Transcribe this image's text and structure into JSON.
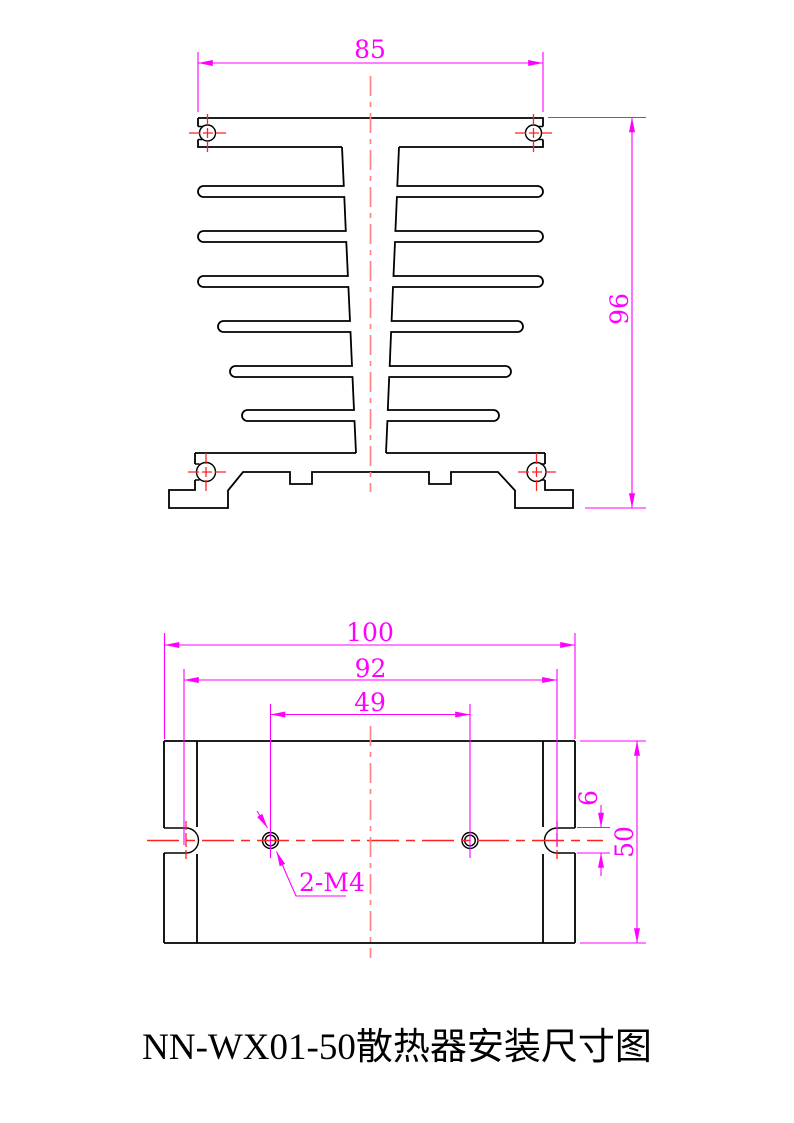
{
  "title": "NN-WX01-50散热器安装尺寸图",
  "front_view": {
    "dim_width": "85",
    "dim_height": "96"
  },
  "bottom_view": {
    "dim_overall_width": "100",
    "dim_slot_span": "92",
    "dim_hole_span": "49",
    "dim_slot_width": "6",
    "dim_depth": "50",
    "hole_callout": "2-M4"
  },
  "colors": {
    "outline": "#000000",
    "dimension": "#ff00ff",
    "centerline_red": "#ff2222",
    "centerline_salmon": "#ff8585",
    "background": "#ffffff"
  }
}
